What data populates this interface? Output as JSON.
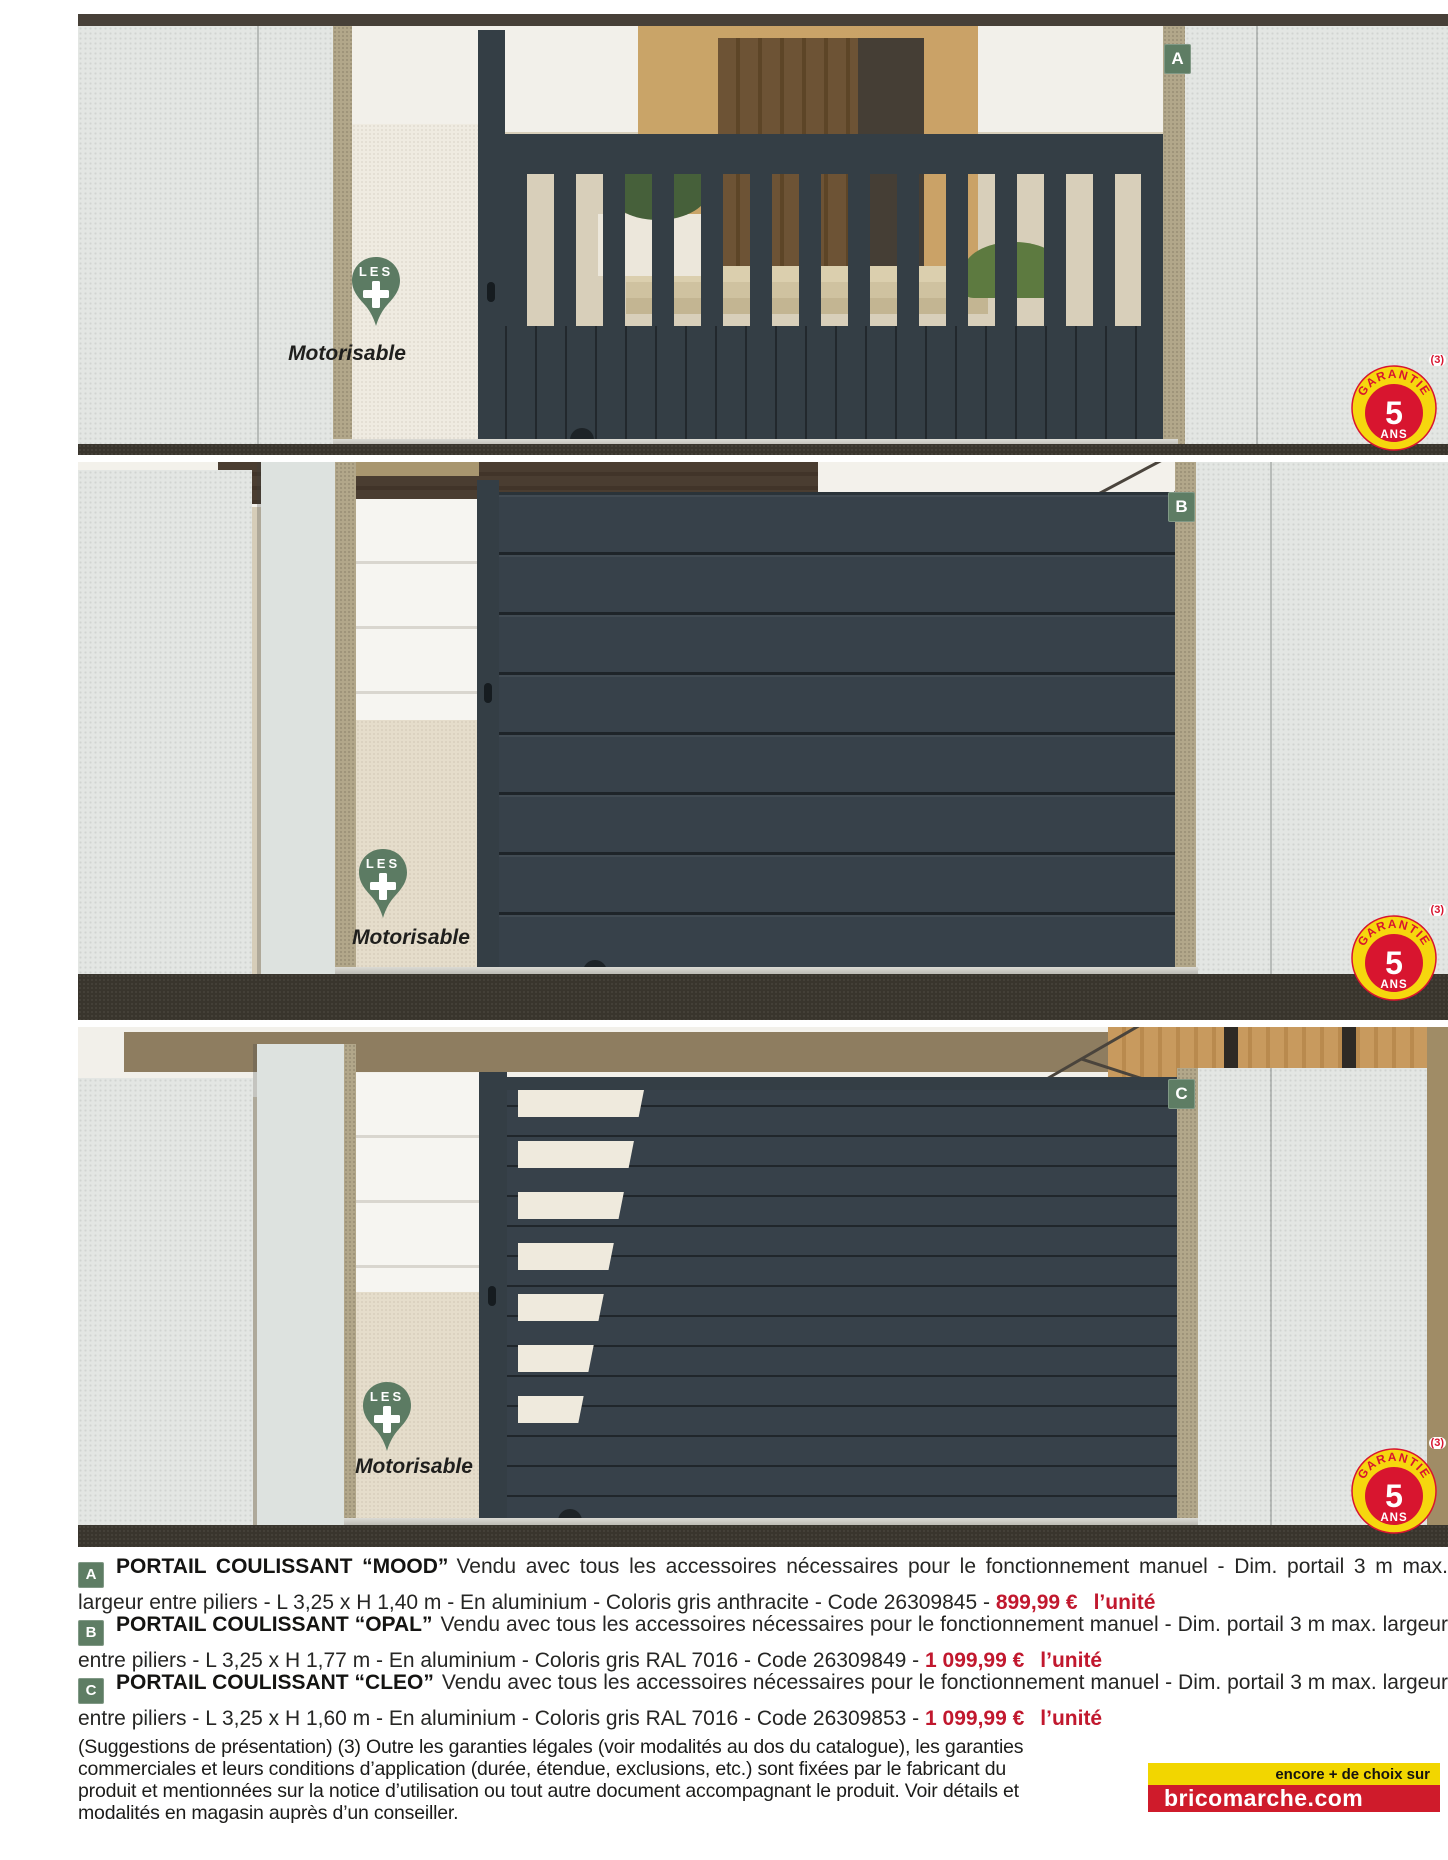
{
  "colors": {
    "gate_anthracite": "#343e45",
    "badge_green": "#5e7d64",
    "price_red": "#c1182e",
    "logo_yellow": "#f2d600",
    "logo_red": "#cf1b2b",
    "warranty_yellow": "#f6d70e",
    "warranty_red": "#d8152f",
    "ground_dark": "#39352d",
    "pillar_grey": "#e3e6e3"
  },
  "photos": [
    {
      "letter": "A",
      "les_label": "LES",
      "motorisable_label": "Motorisable",
      "garantie": {
        "arc_text": "GARANTIE",
        "years": "5",
        "ans": "ANS",
        "footnote": "(3)"
      }
    },
    {
      "letter": "B",
      "les_label": "LES",
      "motorisable_label": "Motorisable",
      "garantie": {
        "arc_text": "GARANTIE",
        "years": "5",
        "ans": "ANS",
        "footnote": "(3)"
      }
    },
    {
      "letter": "C",
      "les_label": "LES",
      "motorisable_label": "Motorisable",
      "garantie": {
        "arc_text": "GARANTIE",
        "years": "5",
        "ans": "ANS",
        "footnote": "(3)"
      }
    }
  ],
  "products": [
    {
      "letter": "A",
      "title": "PORTAIL COULISSANT “MOOD”",
      "description": "Vendu avec tous les accessoires nécessaires pour le fonctionnement manuel - Dim. portail 3 m max. largeur entre piliers - L 3,25 x H 1,40 m - En aluminium - Coloris gris anthracite - Code 26309845 -",
      "price": "899,99 €",
      "unit": "l’unité"
    },
    {
      "letter": "B",
      "title": "PORTAIL COULISSANT “OPAL”",
      "description": "Vendu avec tous les accessoires nécessaires pour le fonctionnement manuel - Dim. portail 3 m max. largeur entre piliers - L 3,25 x H 1,77 m - En aluminium - Coloris gris RAL 7016 - Code 26309849 -",
      "price": "1 099,99 €",
      "unit": "l’unité"
    },
    {
      "letter": "C",
      "title": "PORTAIL COULISSANT “CLEO”",
      "description": "Vendu avec tous les accessoires nécessaires pour le fonctionnement manuel - Dim. portail 3 m max. largeur entre piliers - L 3,25 x H 1,60 m - En aluminium - Coloris gris RAL 7016 - Code 26309853 -",
      "price": "1 099,99 €",
      "unit": "l’unité"
    },
    {
      "note": "(Suggestions de présentation)"
    }
  ],
  "legal": {
    "text": "(Suggestions de présentation) (3) Outre les garanties légales (voir modalités au dos du catalogue), les garanties commerciales et leurs conditions d’application (durée, étendue, exclusions, etc.) sont fixées par le fabricant du produit et mentionnées sur la notice d’utilisation ou tout autre document accompagnant le produit. Voir détails et modalités en magasin auprès d’un conseiller."
  },
  "footer": {
    "tagline": "encore + de choix sur",
    "site": "bricomarche.com"
  }
}
